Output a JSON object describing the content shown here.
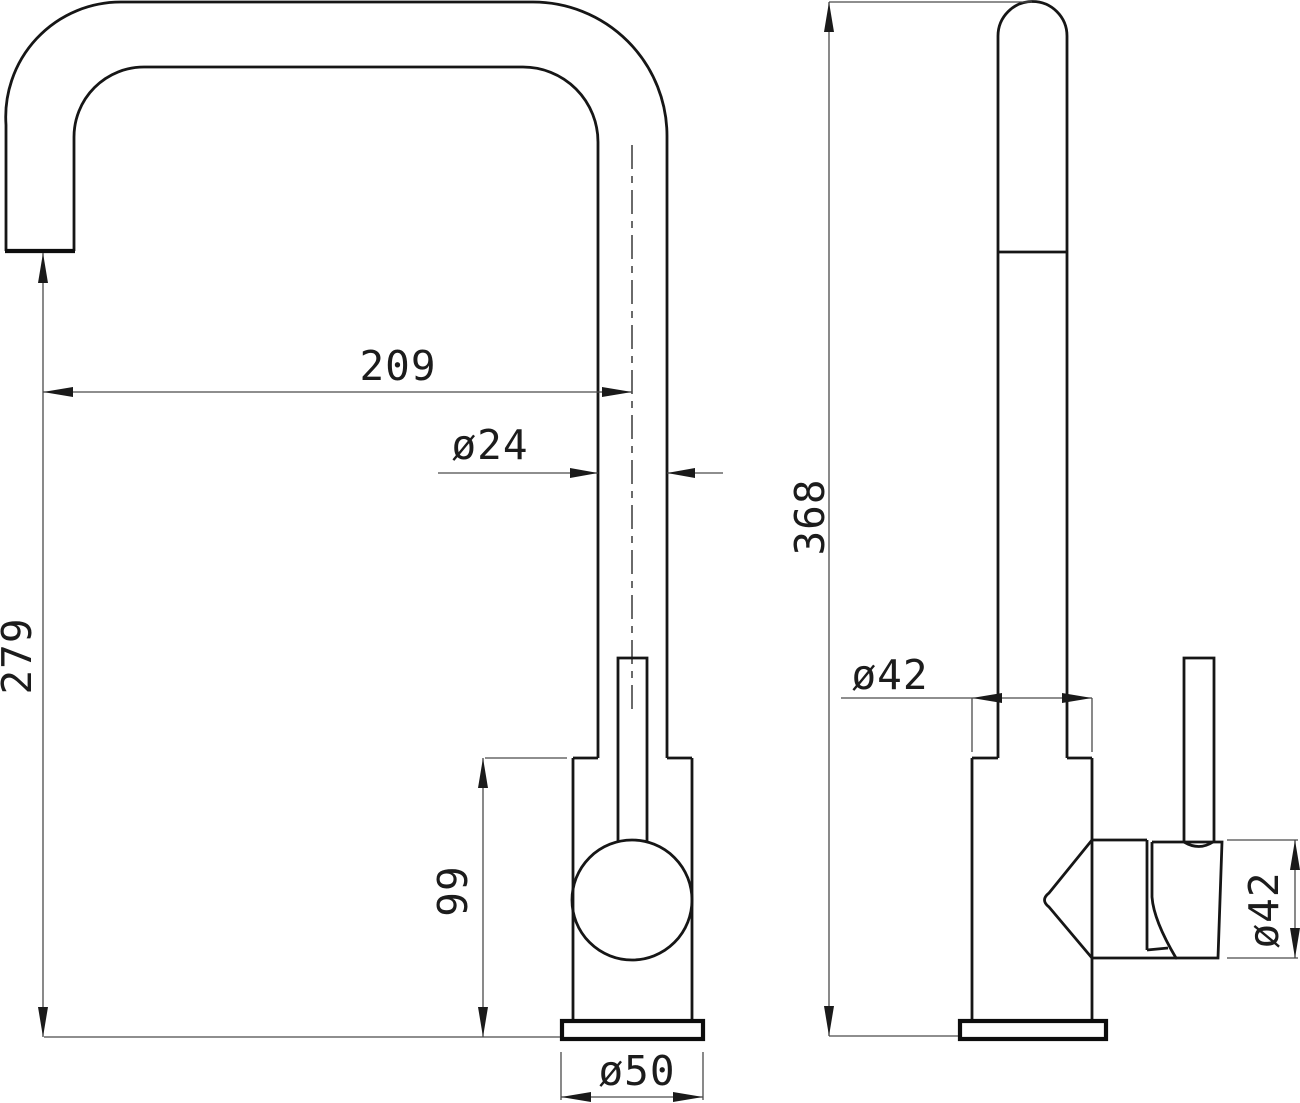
{
  "drawing": {
    "type": "faucet-dimension-drawing",
    "views": {
      "front_view": "front elevation of kitchen mixer tap",
      "side_view": "side elevation of kitchen mixer tap"
    },
    "dimensions": {
      "spout_reach": "209",
      "spout_tube_diameter": "ø24",
      "outlet_height": "279",
      "overall_height": "368",
      "body_height": "99",
      "base_plate_diameter": "ø50",
      "body_diameter": "ø42",
      "valve_housing_diameter": "ø42"
    },
    "colors": {
      "background": "#ffffff",
      "object_lines": "#161616",
      "dimension_lines": "#4a4a4a",
      "text": "#1c1c1c"
    }
  }
}
